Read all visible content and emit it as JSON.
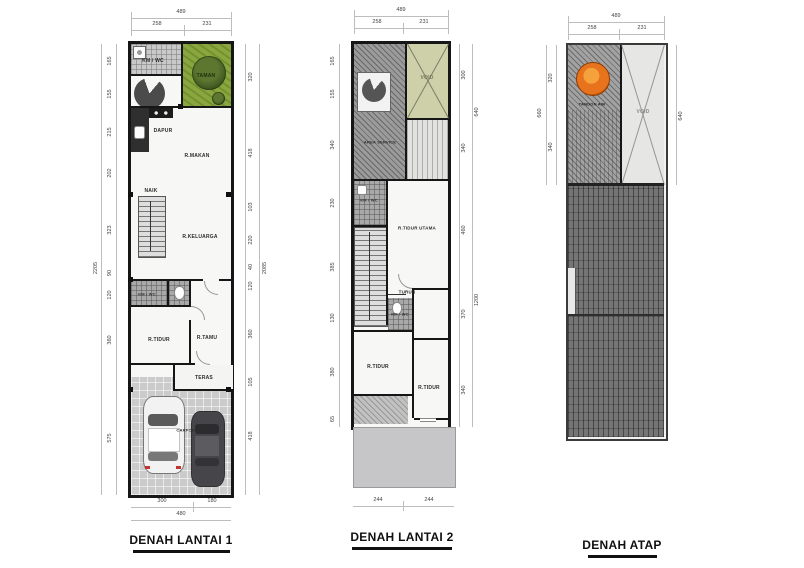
{
  "colors": {
    "wall_black": "#161616",
    "garden_green": "#8aa63e",
    "void_green": "#cdd0a8",
    "roof_dark": "#757575",
    "tank_orange": "#e8731d"
  },
  "icons": {
    "washer": "washer-icon",
    "stove": "stove-icon",
    "sink": "sink-icon",
    "toilet": "toilet-icon",
    "tree": "tree-icon",
    "plant": "plant-icon",
    "spiral_stair": "spiral-stair-icon",
    "white_car": "white-car-icon",
    "dark_car": "dark-car-icon",
    "water_tank": "water-tank-icon"
  },
  "plan1": {
    "title": "DENAH LANTAI 1",
    "rooms": {
      "kmwc_top": "KM / WC",
      "taman": "TAMAN",
      "dapur": "DAPUR",
      "r_makan": "R.MAKAN",
      "naik": "NAIK",
      "r_keluarga": "R.KELUARGA",
      "kmwc_mid": "KM / WC",
      "r_tidur": "R.TIDUR",
      "r_tamu": "R.TAMU",
      "teras": "TERAS",
      "carport": "CARPORT"
    },
    "dims": {
      "top_total": "489",
      "top": [
        "258",
        "231"
      ],
      "bottom": [
        "300",
        "180"
      ],
      "bottom_total": "480",
      "left": [
        "165",
        "155",
        "215",
        "202",
        "323",
        "90",
        "120",
        "360",
        "575"
      ],
      "left_total": "2205",
      "right": [
        "320",
        "418",
        "103",
        "220",
        "40",
        "120",
        "360",
        "105",
        "418"
      ],
      "right_total": "2085"
    }
  },
  "plan2": {
    "title": "DENAH LANTAI 2",
    "rooms": {
      "area_service": "AREA SERVICE",
      "void": "VOID",
      "kmwc_1": "KM / WC",
      "r_tidur_utama": "R.TIDUR UTAMA",
      "turun": "TURUN",
      "kmwc_2": "KM / WC",
      "r_tidur_a": "R.TIDUR",
      "r_tidur_b": "R.TIDUR"
    },
    "dims": {
      "top_total": "489",
      "top": [
        "258",
        "231"
      ],
      "left": [
        "165",
        "155",
        "340",
        "230",
        "385",
        "130",
        "380",
        "65"
      ],
      "right": [
        "300",
        "340",
        "460",
        "370",
        "340"
      ],
      "right_outer": [
        "640",
        "1200"
      ],
      "bottom": [
        "244",
        "244"
      ]
    }
  },
  "plan3": {
    "title": "DENAH ATAP",
    "labels": {
      "tandon": "TANDON AIR",
      "void": "VOID"
    },
    "dims": {
      "top_total": "489",
      "top": [
        "258",
        "231"
      ],
      "left": [
        "320",
        "340"
      ],
      "left_outer": "660",
      "right": "640"
    }
  }
}
